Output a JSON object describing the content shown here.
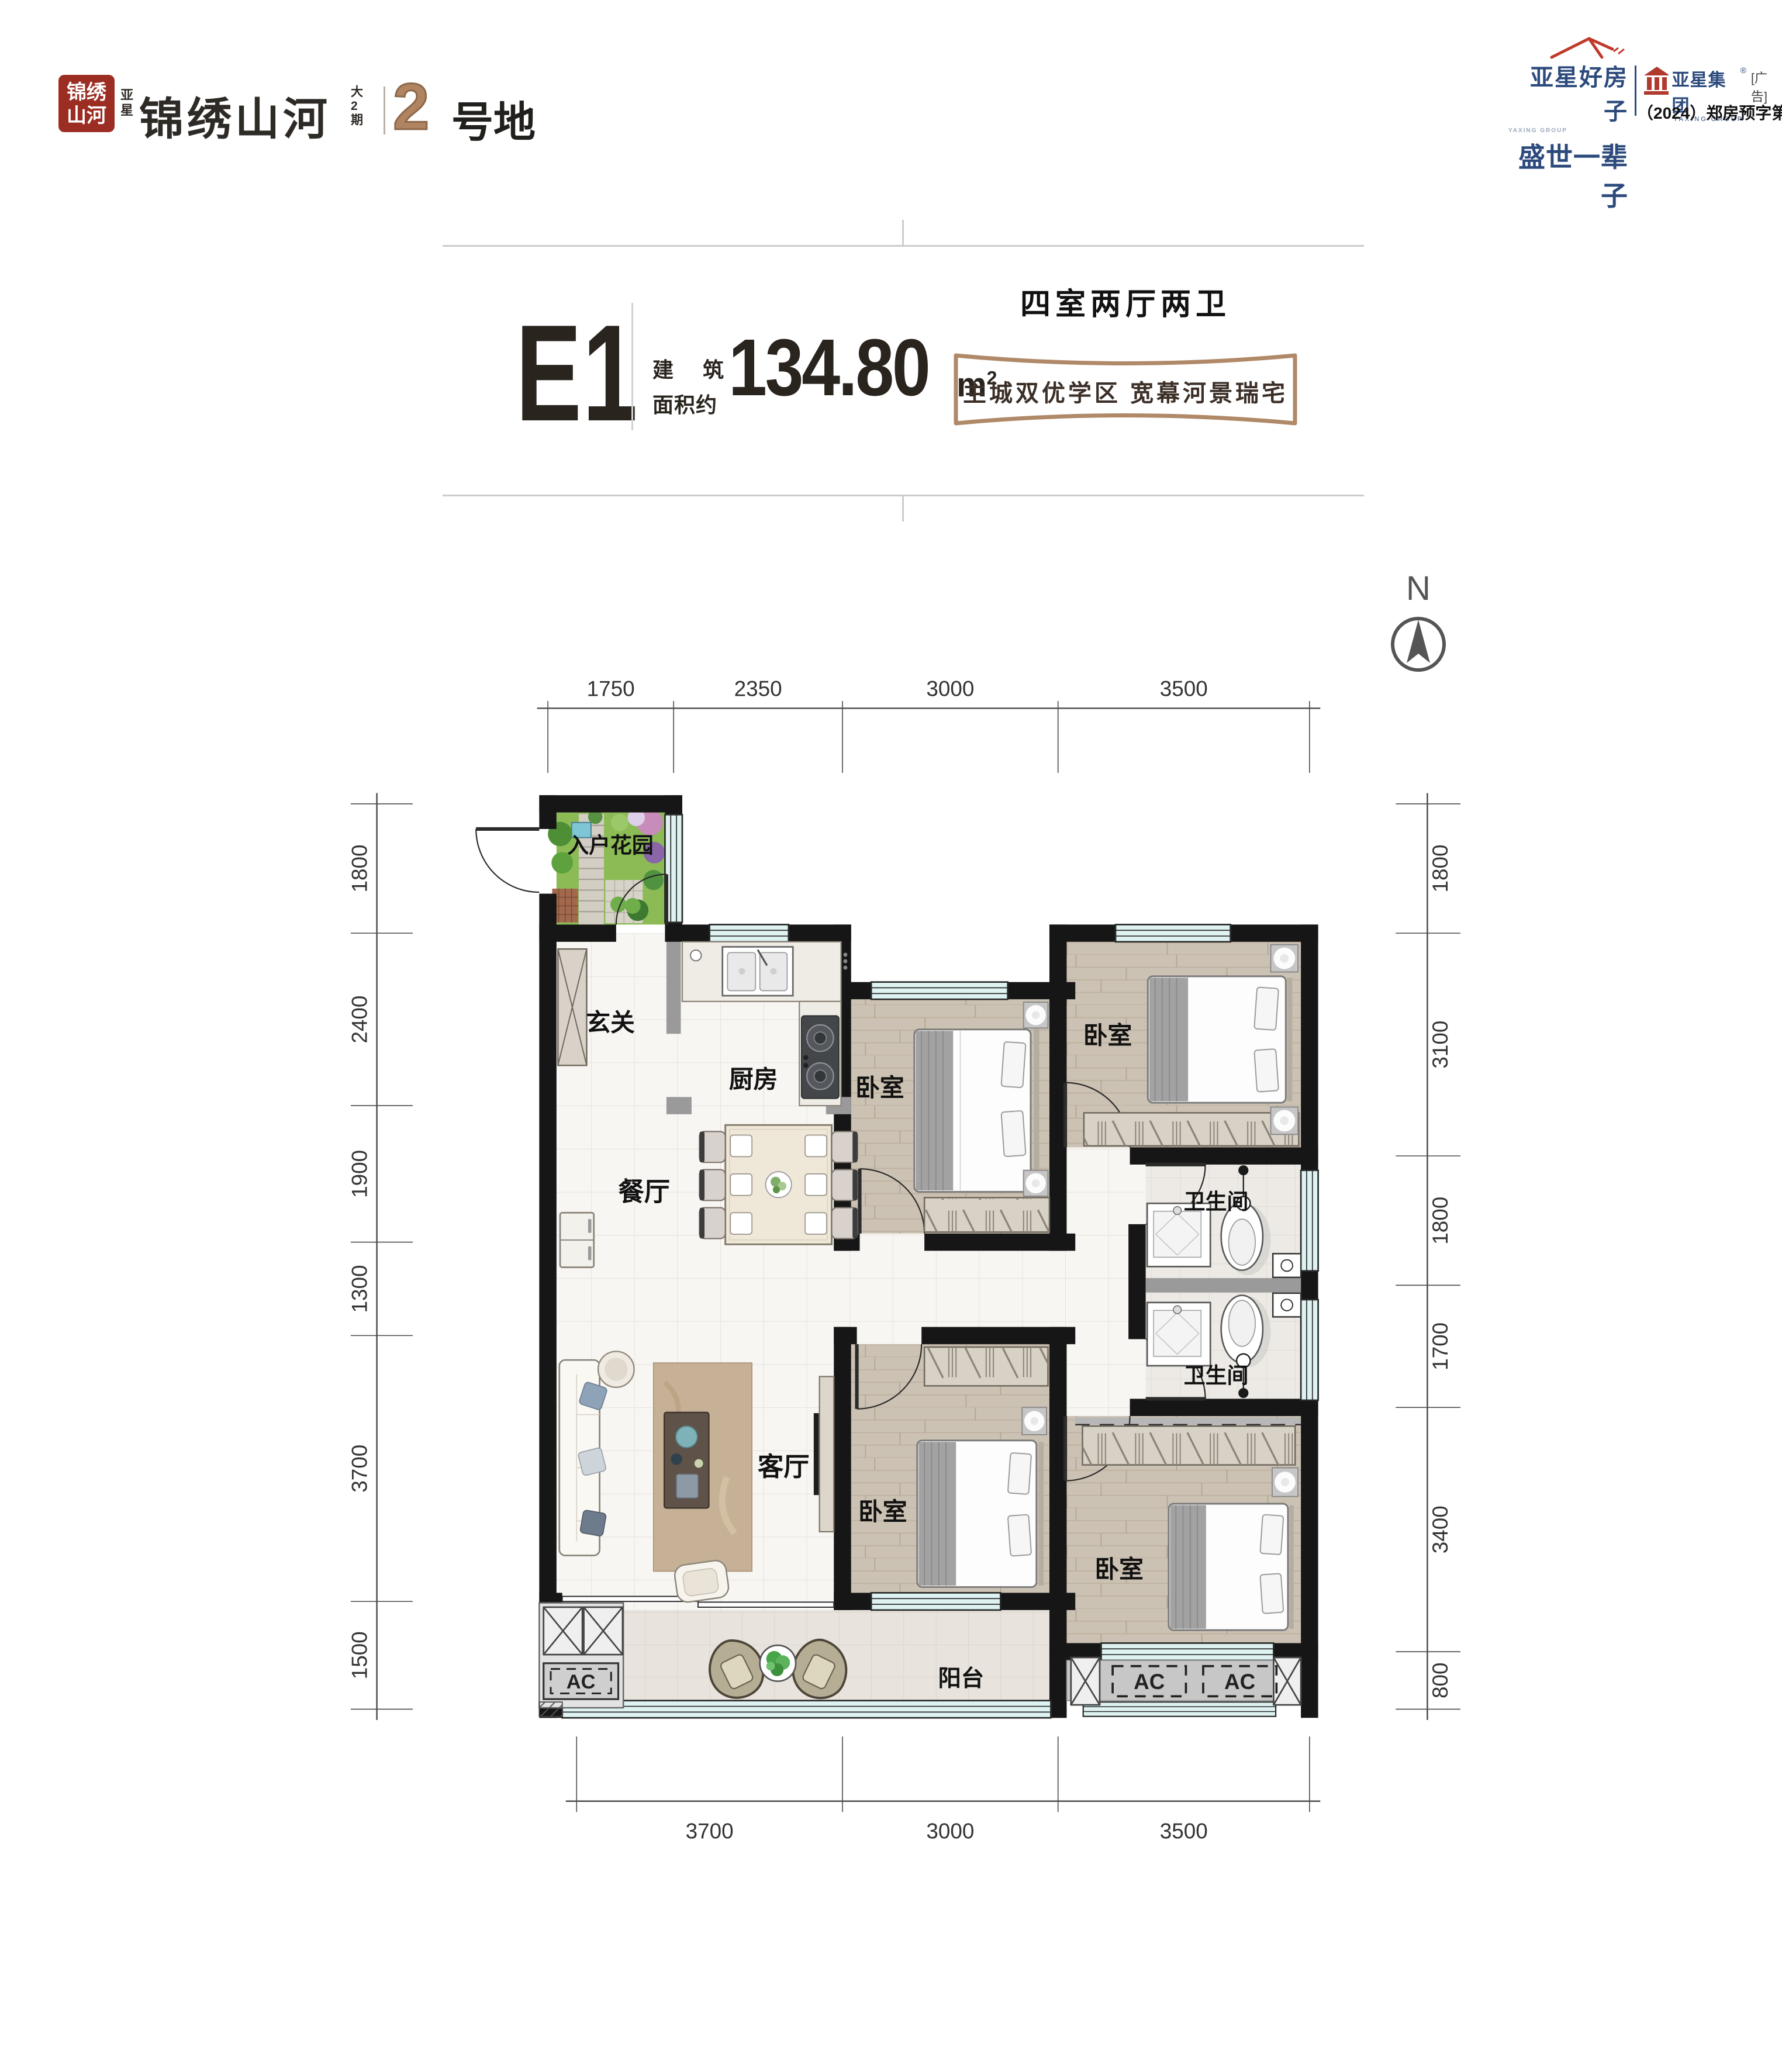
{
  "logo": {
    "seal_line1": "锦绣",
    "seal_line2": "山河",
    "prefix_l1": "亚",
    "prefix_l2": "星",
    "name": "锦绣山河",
    "suffix_l1": "大",
    "suffix_l2": "2",
    "suffix_l3": "期",
    "plot_number": "2",
    "plot_label": "号地"
  },
  "brand": {
    "slogan_line1": "亚星好房子",
    "slogan_line2": "盛世一辈子",
    "slogan_small": "YAXING GROUP",
    "group_name": "亚星集团",
    "group_reg": "®",
    "ad_tag": "[广告]",
    "group_en": "YAXING GROUP",
    "permit": "（2024）郑房预字第5808号"
  },
  "unit": {
    "code": "E1",
    "area_label_l1a": "建",
    "area_label_l1b": "筑",
    "area_label_l2": "面积约",
    "area_value": "134.80",
    "area_unit": "m",
    "area_sup": "2",
    "layout": "四室两厅两卫",
    "tagline": "主城双优学区  宽幕河景瑞宅"
  },
  "compass": {
    "label": "N"
  },
  "plan": {
    "rooms": {
      "garden": "入户花园",
      "foyer": "玄关",
      "kitchen": "厨房",
      "dining": "餐厅",
      "living": "客厅",
      "bedroom": "卧室",
      "bath": "卫生间",
      "balcony": "阳台"
    },
    "ac_label": "AC"
  },
  "dims": {
    "top": [
      "1750",
      "2350",
      "3000",
      "3500"
    ],
    "left": [
      "1800",
      "2400",
      "1900",
      "1300",
      "3700",
      "1500"
    ],
    "right": [
      "1800",
      "3100",
      "1800",
      "1700",
      "3400",
      "800"
    ],
    "bottom": [
      "3700",
      "3000",
      "3500"
    ]
  }
}
